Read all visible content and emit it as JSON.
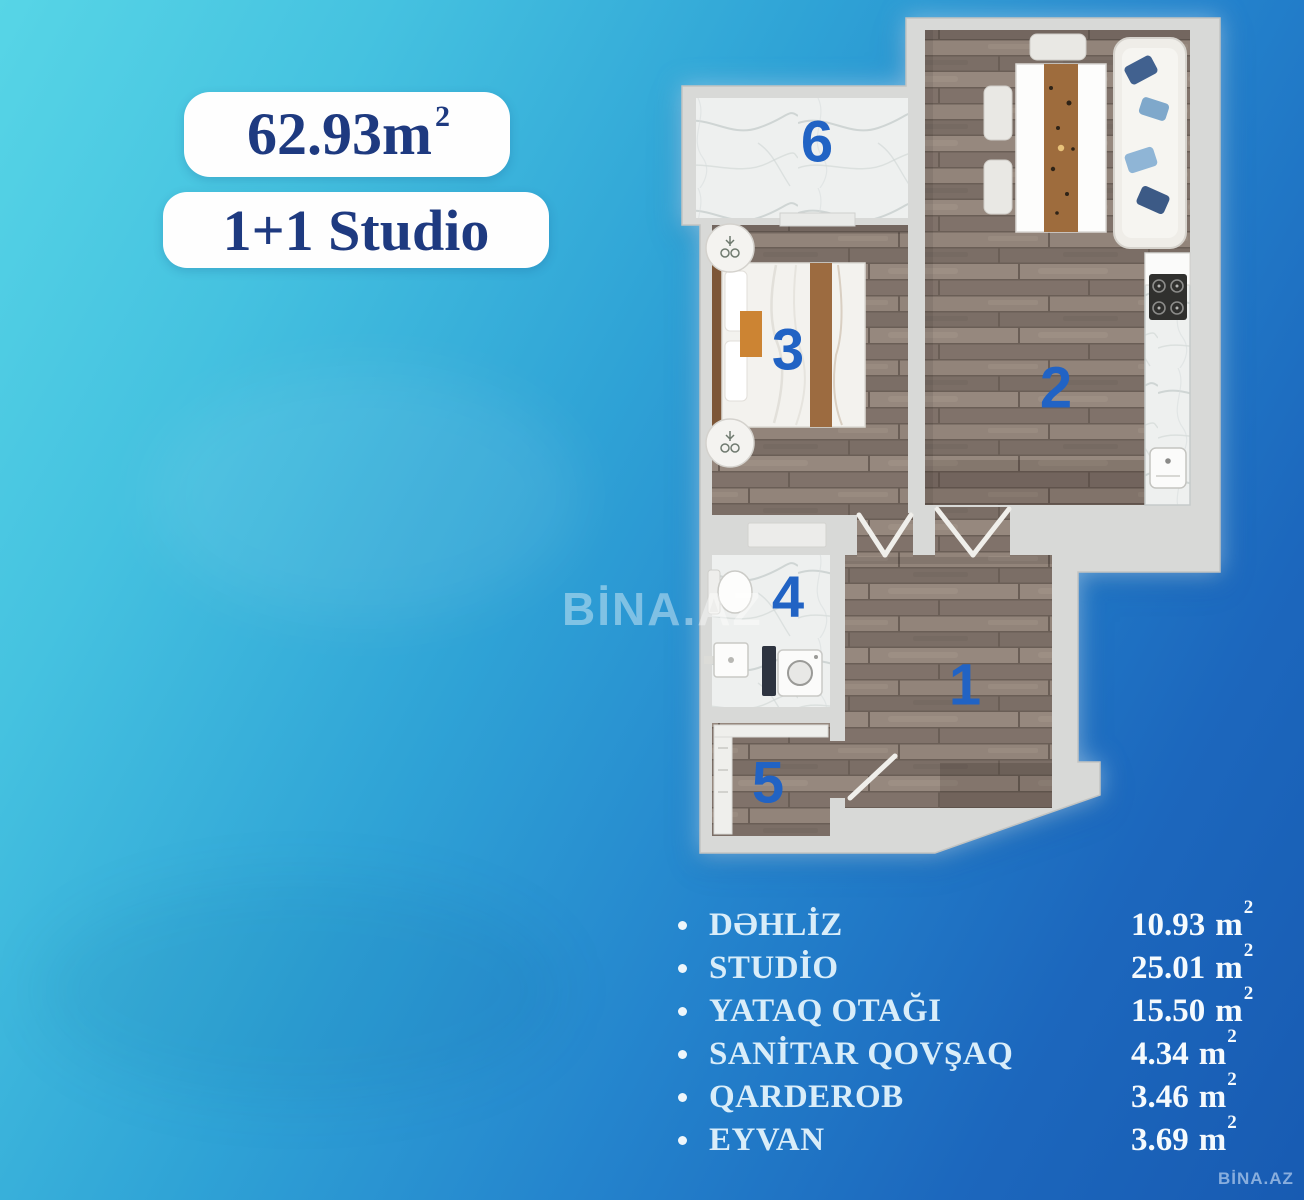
{
  "badges": {
    "area_value": "62.93m",
    "area_sup": "2",
    "layout_type": "1+1 Studio"
  },
  "plan": {
    "room_numbers": [
      "1",
      "2",
      "3",
      "4",
      "5",
      "6"
    ]
  },
  "legend": {
    "unit": "m",
    "unit_sup": "2",
    "items": [
      {
        "label": "DƏHLİZ",
        "value": "10.93"
      },
      {
        "label": "STUDİO",
        "value": "25.01"
      },
      {
        "label": "YATAQ OTAĞI",
        "value": "15.50"
      },
      {
        "label": "SANİTAR QOVŞAQ",
        "value": "4.34"
      },
      {
        "label": "QARDEROB",
        "value": "3.46"
      },
      {
        "label": "EYVAN",
        "value": "3.69"
      }
    ]
  },
  "watermarks": {
    "center": "BİNA.AZ",
    "corner": "BİNA.AZ"
  },
  "colors": {
    "background_top_left": "#57d5e6",
    "background_bottom_right": "#185bb2",
    "badge_text": "#1e3a80",
    "room_number_blue": "#2163c4",
    "wall_gray": "#d8d9d7",
    "wood_floor": "#8d7f75",
    "marble_floor": "#eef0ef"
  }
}
